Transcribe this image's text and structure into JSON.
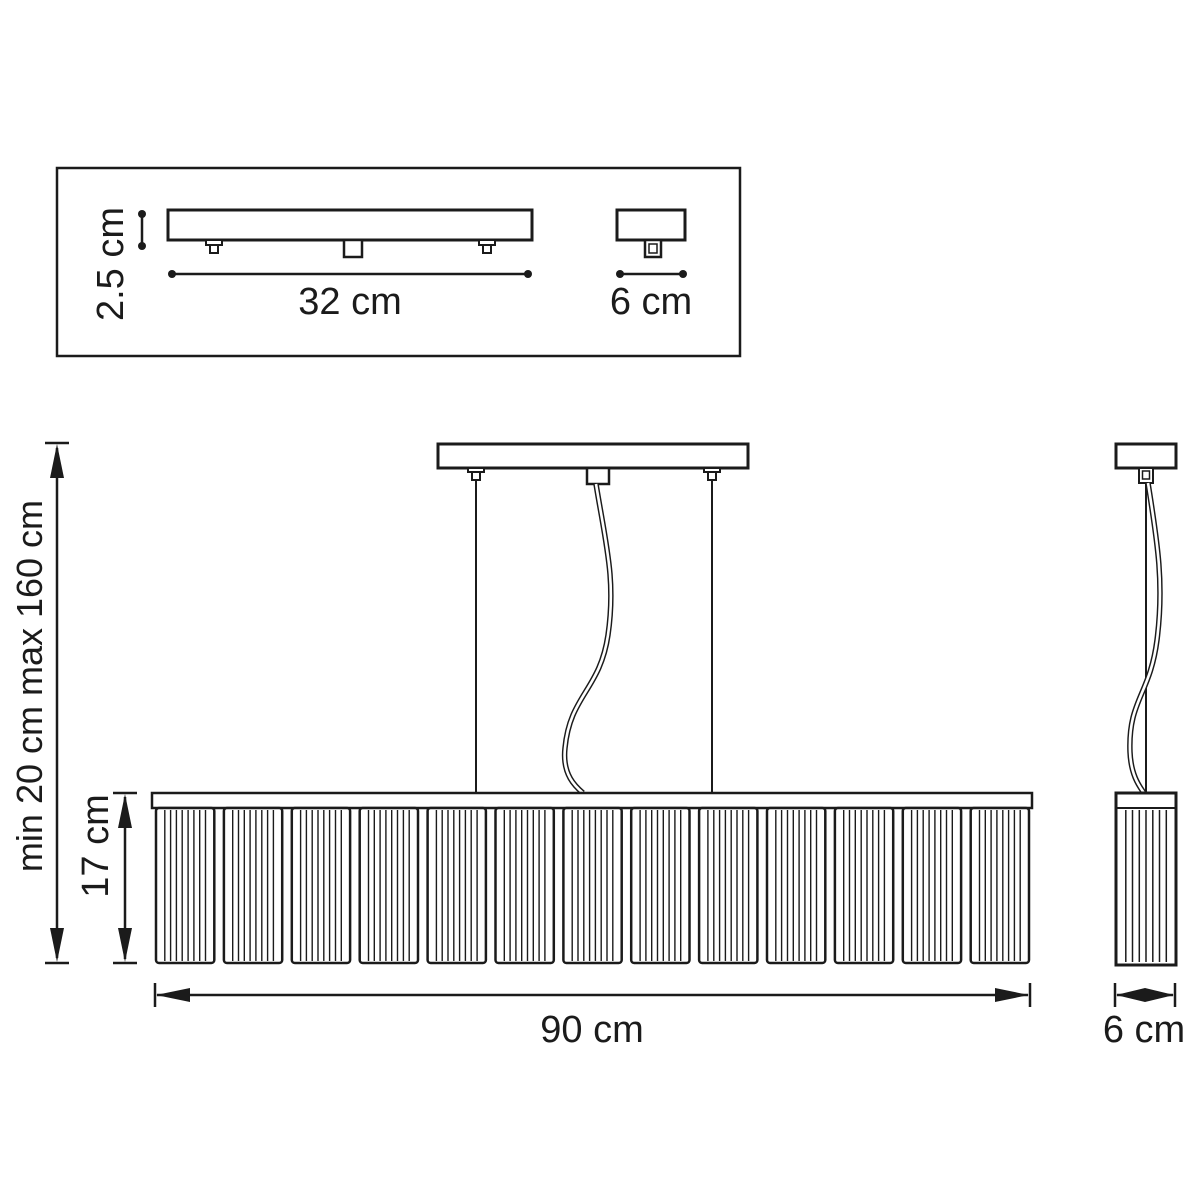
{
  "style": {
    "line_color": "#1b1b1b",
    "background_color": "#ffffff"
  },
  "inset": {
    "plate_height": "2.5 cm",
    "plate_length": "32 cm",
    "plate_depth": "6 cm"
  },
  "front_view": {
    "suspension_range": "min 20 cm max 160 cm",
    "shade_height": "17 cm",
    "shade_width": "90 cm"
  },
  "side_view": {
    "shade_depth": "6 cm"
  },
  "structure": {
    "front_panel_count": 13,
    "front_panel_stripe_count": 8,
    "side_stripe_count": 7
  }
}
